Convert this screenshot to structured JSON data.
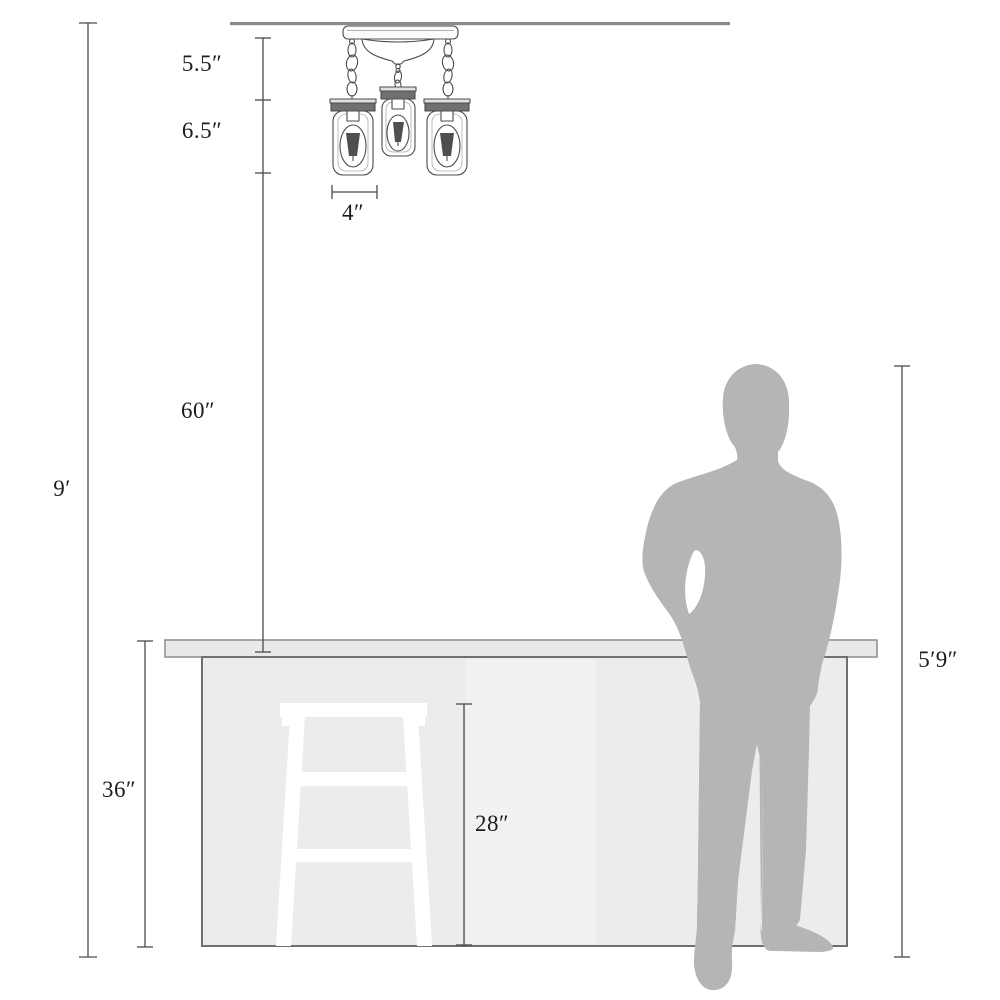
{
  "diagram": {
    "type": "product-dimension-diagram",
    "subject": "3-light mason jar semi-flush ceiling fixture shown to scale with kitchen island, bar stool and person"
  },
  "labels": {
    "canopy_drop": "5.5″",
    "jar_section_height": "6.5″",
    "jar_width": "4″",
    "hanging_drop": "60″",
    "ceiling_height": "9′",
    "island_height": "36″",
    "stool_height": "28″",
    "person_height": "5′9″"
  },
  "colors": {
    "dimension_line": "#4a4a4a",
    "label_text": "#1c1c1c",
    "ceiling": "#8a8a8a",
    "fixture_line": "#4c4c4c",
    "person_silhouette": "#b5b5b5",
    "island_fill": "#ececec",
    "countertop_fill": "#e9e9e9",
    "stool_fill": "#ffffff"
  }
}
